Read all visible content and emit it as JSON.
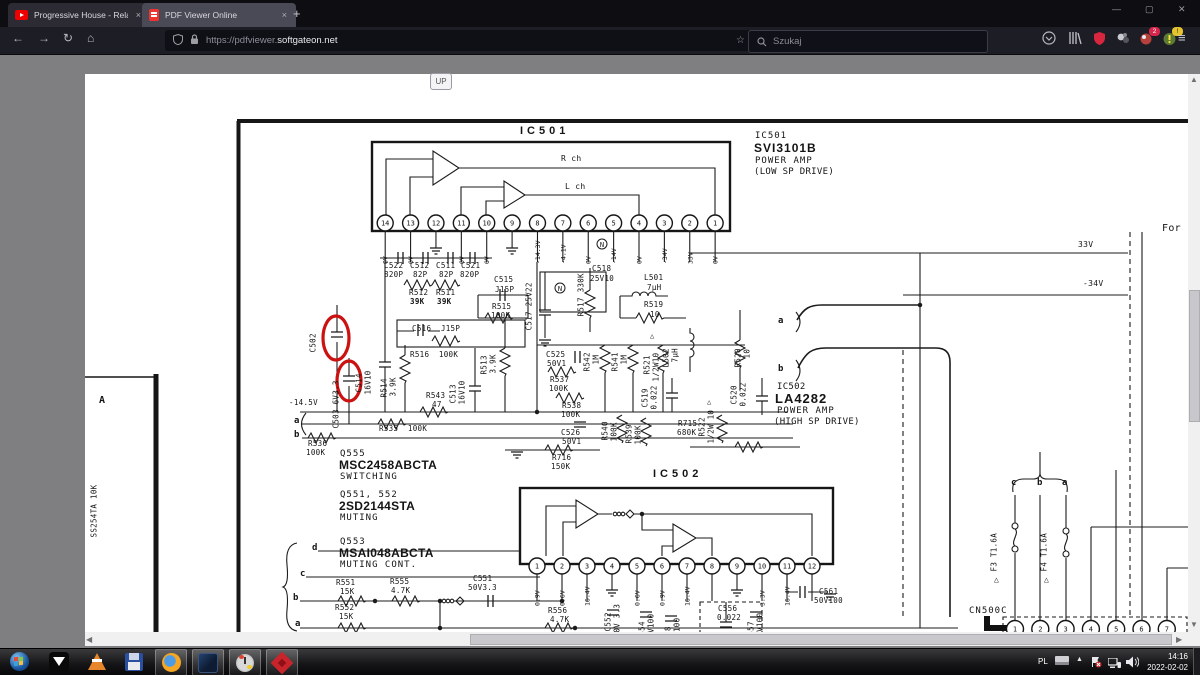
{
  "browser": {
    "tabs": [
      {
        "title": "Progressive House - Relaxing Fo",
        "icon": "youtube",
        "close": "×"
      },
      {
        "title": "PDF Viewer Online",
        "icon": "pdf",
        "close": "×"
      }
    ],
    "new_tab": "+",
    "window_controls": {
      "minimize": "—",
      "maximize": "▢",
      "close": "✕"
    },
    "url_prefix": "https://pdfviewer.",
    "url_domain": "softgateon.net",
    "search_placeholder": "Szukaj",
    "extension_badge": "2",
    "warning_badge": "!",
    "menu_icon": "≡"
  },
  "pdf_toolbar": {
    "page_label": "Strona:",
    "page_value": "13",
    "page_total": "z 26",
    "zoom_value": "250%",
    "more_tools": "»"
  },
  "page_overlay": {
    "up_button": "UP"
  },
  "annotation_color": "#cc1111",
  "schematic": {
    "ic501": {
      "pins": [
        "14",
        "13",
        "12",
        "11",
        "10",
        "9",
        "8",
        "7",
        "6",
        "5",
        "4",
        "3",
        "2",
        "1"
      ],
      "voltages": [
        "0V",
        "0V",
        "GND",
        "0V",
        "0V",
        "GND",
        "-14.3V",
        "-4.1V",
        "0V",
        "-14V",
        "0V",
        "-34V",
        "33V",
        "0V"
      ]
    },
    "ic502": {
      "pins": [
        "1",
        "2",
        "3",
        "4",
        "5",
        "6",
        "7",
        "8",
        "9",
        "10",
        "11",
        "12"
      ],
      "voltages": [
        "0.9V",
        "0.6V",
        "16.4V",
        "GND",
        "0.6V",
        "0.9V",
        "16.4V",
        "",
        "GND",
        "3.3V",
        "16.4V",
        ""
      ]
    },
    "cn500c": {
      "pins": [
        "1",
        "2",
        "3",
        "4",
        "5",
        "6",
        "7"
      ]
    },
    "labels": [
      {
        "t": "IC501",
        "x": 520,
        "y": 126,
        "s": 11,
        "b": 1,
        "ls": 4
      },
      {
        "t": "R ch",
        "x": 561,
        "y": 155,
        "s": 8
      },
      {
        "t": "L ch",
        "x": 565,
        "y": 183,
        "s": 8
      },
      {
        "t": "IC501",
        "x": 755,
        "y": 132,
        "s": 9,
        "ls": 1
      },
      {
        "t": "SVI3101B",
        "x": 754,
        "y": 142,
        "s": 12,
        "b": 1,
        "ls": 1
      },
      {
        "t": "POWER AMP",
        "x": 755,
        "y": 157,
        "s": 9,
        "ls": 1
      },
      {
        "t": "(LOW SP DRIVE)",
        "x": 754,
        "y": 168,
        "s": 9
      },
      {
        "t": "For",
        "x": 1162,
        "y": 224,
        "s": 10
      },
      {
        "t": "33V",
        "x": 1078,
        "y": 241,
        "s": 8
      },
      {
        "t": "-34V",
        "x": 1083,
        "y": 280,
        "s": 8
      },
      {
        "t": "C522",
        "x": 384,
        "y": 262
      },
      {
        "t": "820P",
        "x": 384,
        "y": 271
      },
      {
        "t": "C512",
        "x": 410,
        "y": 262
      },
      {
        "t": "82P",
        "x": 413,
        "y": 271
      },
      {
        "t": "C511",
        "x": 436,
        "y": 262
      },
      {
        "t": "82P",
        "x": 439,
        "y": 271
      },
      {
        "t": "C521",
        "x": 461,
        "y": 262
      },
      {
        "t": "820P",
        "x": 460,
        "y": 271
      },
      {
        "t": "R512",
        "x": 409,
        "y": 289
      },
      {
        "t": "39K",
        "x": 410,
        "y": 298,
        "b": 1
      },
      {
        "t": "R511",
        "x": 436,
        "y": 289
      },
      {
        "t": "39K",
        "x": 437,
        "y": 298,
        "b": 1
      },
      {
        "t": "C515",
        "x": 494,
        "y": 276
      },
      {
        "t": "J15P",
        "x": 495,
        "y": 286
      },
      {
        "t": "R515",
        "x": 492,
        "y": 303
      },
      {
        "t": "100K",
        "x": 491,
        "y": 312
      },
      {
        "t": "C516  J15P",
        "x": 412,
        "y": 325
      },
      {
        "t": "R516  100K",
        "x": 410,
        "y": 351
      },
      {
        "t": "C518",
        "x": 592,
        "y": 265
      },
      {
        "t": "25V10",
        "x": 590,
        "y": 275
      },
      {
        "t": "L501",
        "x": 644,
        "y": 274
      },
      {
        "t": "7μH",
        "x": 647,
        "y": 284
      },
      {
        "t": "R519",
        "x": 644,
        "y": 301
      },
      {
        "t": "10",
        "x": 650,
        "y": 311
      },
      {
        "t": "R543",
        "x": 426,
        "y": 392
      },
      {
        "t": "47",
        "x": 432,
        "y": 401
      },
      {
        "t": "-14.5V",
        "x": 289,
        "y": 399
      },
      {
        "t": "a",
        "x": 294,
        "y": 417,
        "s": 9,
        "b": 1
      },
      {
        "t": "b",
        "x": 294,
        "y": 431,
        "s": 9,
        "b": 1
      },
      {
        "t": "R535  100K",
        "x": 379,
        "y": 425
      },
      {
        "t": "R536",
        "x": 308,
        "y": 440
      },
      {
        "t": "100K",
        "x": 306,
        "y": 449
      },
      {
        "t": "Q555",
        "x": 340,
        "y": 450,
        "s": 9,
        "ls": 1
      },
      {
        "t": "MSC2458ABCTA",
        "x": 339,
        "y": 459,
        "s": 12,
        "b": 1
      },
      {
        "t": "SWITCHING",
        "x": 340,
        "y": 473,
        "s": 9,
        "ls": 1
      },
      {
        "t": "Q551, 552",
        "x": 340,
        "y": 491,
        "s": 9,
        "ls": 1
      },
      {
        "t": "2SD2144STA",
        "x": 339,
        "y": 500,
        "s": 12,
        "b": 1
      },
      {
        "t": "MUTING",
        "x": 340,
        "y": 514,
        "s": 9,
        "ls": 1
      },
      {
        "t": "Q553",
        "x": 340,
        "y": 538,
        "s": 9,
        "ls": 1
      },
      {
        "t": "MSAI048ABCTA",
        "x": 339,
        "y": 547,
        "s": 12,
        "b": 1
      },
      {
        "t": "MUTING CONT.",
        "x": 340,
        "y": 561,
        "s": 9,
        "ls": 1
      },
      {
        "t": "d",
        "x": 312,
        "y": 544,
        "s": 9,
        "b": 1
      },
      {
        "t": "c",
        "x": 300,
        "y": 570,
        "s": 9,
        "b": 1
      },
      {
        "t": "b",
        "x": 293,
        "y": 594,
        "s": 9,
        "b": 1
      },
      {
        "t": "a",
        "x": 295,
        "y": 620,
        "s": 9,
        "b": 1
      },
      {
        "t": "IC502",
        "x": 653,
        "y": 469,
        "s": 11,
        "b": 1,
        "ls": 4
      },
      {
        "t": "IC502",
        "x": 777,
        "y": 383,
        "s": 9
      },
      {
        "t": "LA4282",
        "x": 775,
        "y": 392,
        "s": 13,
        "b": 1,
        "ls": 1
      },
      {
        "t": "POWER AMP",
        "x": 777,
        "y": 407,
        "s": 9,
        "ls": 1
      },
      {
        "t": "(HIGH SP DRIVE)",
        "x": 774,
        "y": 418,
        "s": 9
      },
      {
        "t": "a",
        "x": 778,
        "y": 317,
        "s": 9,
        "b": 1
      },
      {
        "t": "b",
        "x": 778,
        "y": 365,
        "s": 9,
        "b": 1
      },
      {
        "t": "C525",
        "x": 546,
        "y": 351
      },
      {
        "t": "50V1",
        "x": 547,
        "y": 360
      },
      {
        "t": "R537",
        "x": 550,
        "y": 376
      },
      {
        "t": "100K",
        "x": 549,
        "y": 385
      },
      {
        "t": "R538",
        "x": 562,
        "y": 402
      },
      {
        "t": "100K",
        "x": 561,
        "y": 411
      },
      {
        "t": "C526",
        "x": 561,
        "y": 429
      },
      {
        "t": "50V1",
        "x": 562,
        "y": 438
      },
      {
        "t": "R715",
        "x": 678,
        "y": 420
      },
      {
        "t": "680K",
        "x": 677,
        "y": 429
      },
      {
        "t": "R716",
        "x": 552,
        "y": 454
      },
      {
        "t": "150K",
        "x": 551,
        "y": 463
      },
      {
        "t": "R551",
        "x": 336,
        "y": 579
      },
      {
        "t": "15K",
        "x": 340,
        "y": 588
      },
      {
        "t": "R555",
        "x": 390,
        "y": 578
      },
      {
        "t": "4.7K",
        "x": 391,
        "y": 587
      },
      {
        "t": "C551",
        "x": 473,
        "y": 575
      },
      {
        "t": "50V3.3",
        "x": 468,
        "y": 584
      },
      {
        "t": "R552",
        "x": 335,
        "y": 604
      },
      {
        "t": "15K",
        "x": 339,
        "y": 613
      },
      {
        "t": "R556",
        "x": 548,
        "y": 607
      },
      {
        "t": "4.7K",
        "x": 550,
        "y": 616
      },
      {
        "t": "C556",
        "x": 718,
        "y": 605
      },
      {
        "t": "0.022",
        "x": 717,
        "y": 614
      },
      {
        "t": "C561",
        "x": 819,
        "y": 588
      },
      {
        "t": "50V100",
        "x": 814,
        "y": 597
      },
      {
        "t": "CN500C",
        "x": 969,
        "y": 607,
        "s": 9,
        "ls": 1
      },
      {
        "t": "c",
        "x": 1011,
        "y": 479,
        "s": 9,
        "b": 1
      },
      {
        "t": "b",
        "x": 1037,
        "y": 479,
        "s": 9,
        "b": 1
      },
      {
        "t": "a",
        "x": 1062,
        "y": 479,
        "s": 9,
        "b": 1
      },
      {
        "t": "A",
        "x": 99,
        "y": 396,
        "s": 10,
        "b": 1
      },
      {
        "t": "△",
        "x": 650,
        "y": 333,
        "s": 7
      },
      {
        "t": "△",
        "x": 707,
        "y": 399,
        "s": 7
      },
      {
        "t": "△",
        "x": 994,
        "y": 576,
        "s": 8
      },
      {
        "t": "△",
        "x": 1044,
        "y": 576,
        "s": 8
      },
      {
        "t": "C502",
        "x": 317,
        "y": 352,
        "r": 1
      },
      {
        "t": "C503 6V3.3",
        "x": 340,
        "y": 428,
        "r": 1
      },
      {
        "t": "C514",
        "x": 363,
        "y": 392,
        "r": 1
      },
      {
        "t": "16V10",
        "x": 372,
        "y": 394,
        "r": 1
      },
      {
        "t": "R514",
        "x": 388,
        "y": 397,
        "r": 1
      },
      {
        "t": "3.9K",
        "x": 397,
        "y": 396,
        "r": 1
      },
      {
        "t": "C513",
        "x": 457,
        "y": 403,
        "r": 1
      },
      {
        "t": "16V10",
        "x": 466,
        "y": 404,
        "r": 1
      },
      {
        "t": "R513",
        "x": 488,
        "y": 374,
        "r": 1
      },
      {
        "t": "3.9K",
        "x": 497,
        "y": 373,
        "r": 1
      },
      {
        "t": "C517 25V22",
        "x": 533,
        "y": 330,
        "r": 1
      },
      {
        "t": "R517 330K",
        "x": 585,
        "y": 316,
        "r": 1
      },
      {
        "t": "R542",
        "x": 591,
        "y": 371,
        "r": 1
      },
      {
        "t": "1M",
        "x": 600,
        "y": 364,
        "r": 1
      },
      {
        "t": "R541",
        "x": 619,
        "y": 371,
        "r": 1
      },
      {
        "t": "1M",
        "x": 628,
        "y": 364,
        "r": 1
      },
      {
        "t": "R521",
        "x": 651,
        "y": 374,
        "r": 1
      },
      {
        "t": "1/2W10",
        "x": 660,
        "y": 381,
        "r": 1
      },
      {
        "t": "L502",
        "x": 670,
        "y": 367,
        "r": 1
      },
      {
        "t": "7μH",
        "x": 679,
        "y": 362,
        "r": 1
      },
      {
        "t": "R520",
        "x": 742,
        "y": 367,
        "r": 1
      },
      {
        "t": "10",
        "x": 751,
        "y": 358,
        "r": 1
      },
      {
        "t": "C520",
        "x": 738,
        "y": 404,
        "r": 1
      },
      {
        "t": "0.022",
        "x": 747,
        "y": 406,
        "r": 1
      },
      {
        "t": "C519",
        "x": 649,
        "y": 407,
        "r": 1
      },
      {
        "t": "0.022",
        "x": 658,
        "y": 409,
        "r": 1
      },
      {
        "t": "R540",
        "x": 609,
        "y": 440,
        "r": 1
      },
      {
        "t": "100K",
        "x": 618,
        "y": 441,
        "r": 1
      },
      {
        "t": "R539",
        "x": 633,
        "y": 443,
        "r": 1
      },
      {
        "t": "100K",
        "x": 642,
        "y": 444,
        "r": 1
      },
      {
        "t": "R522",
        "x": 706,
        "y": 436,
        "r": 1
      },
      {
        "t": "1/2W 10",
        "x": 715,
        "y": 443,
        "r": 1
      },
      {
        "t": "C552",
        "x": 612,
        "y": 631,
        "r": 1
      },
      {
        "t": "50V 3.3",
        "x": 621,
        "y": 637,
        "r": 1
      },
      {
        "t": "C554",
        "x": 646,
        "y": 640,
        "r": 1
      },
      {
        "t": "25V100",
        "x": 655,
        "y": 642,
        "r": 1
      },
      {
        "t": "C558",
        "x": 672,
        "y": 645,
        "r": 1
      },
      {
        "t": "25V100",
        "x": 681,
        "y": 646,
        "r": 1
      },
      {
        "t": "C557",
        "x": 755,
        "y": 640,
        "r": 1
      },
      {
        "t": "25V100",
        "x": 764,
        "y": 641,
        "r": 1
      },
      {
        "t": "F3 T1.6A",
        "x": 998,
        "y": 571,
        "r": 1
      },
      {
        "t": "F4 T1.6A",
        "x": 1048,
        "y": 571,
        "r": 1
      },
      {
        "t": "D951  R957",
        "x": 86,
        "y": 532,
        "r": 1
      },
      {
        "t": "SS254TA 10K",
        "x": 98,
        "y": 537,
        "r": 1
      }
    ]
  },
  "taskbar": {
    "tray_lang": "PL",
    "time": "14:16",
    "date": "2022-02-02"
  }
}
